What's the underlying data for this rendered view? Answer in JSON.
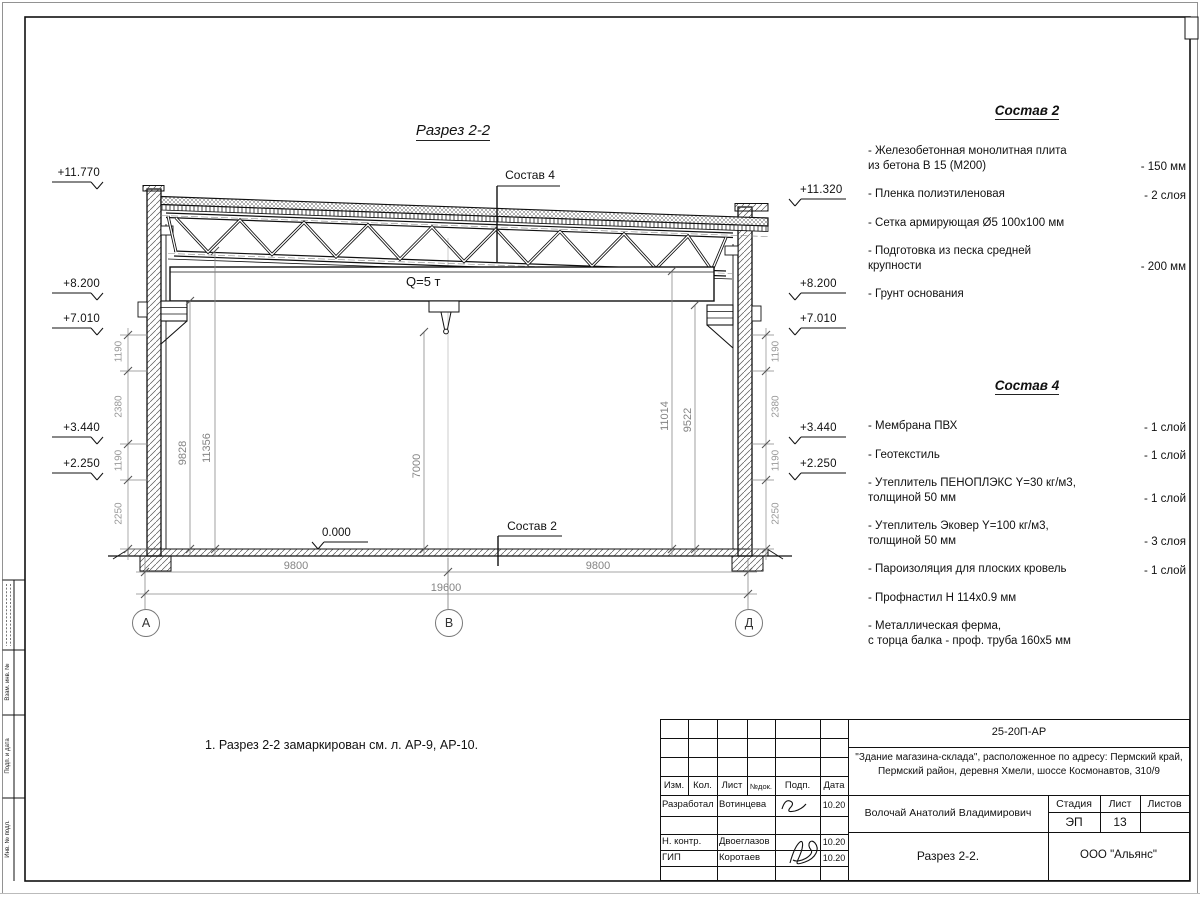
{
  "title": "Разрез 2-2",
  "note": "1. Разрез 2-2 замаркирован см. л. АР-9, АР-10.",
  "drawing": {
    "q_label": "Q=5 т",
    "zero_mark": "0.000",
    "sostav2_ref": "Состав 2",
    "sostav4_ref": "Состав 4",
    "elevations_left": [
      "+11.770",
      "+8.200",
      "+7.010",
      "+3.440",
      "+2.250"
    ],
    "elevations_right": [
      "+11.320",
      "+8.200",
      "+7.010",
      "+3.440",
      "+2.250"
    ],
    "inner_dims": [
      "9828",
      "11356",
      "7000",
      "11014",
      "9522"
    ],
    "chain": [
      "1190",
      "2380",
      "1190",
      "2250"
    ],
    "bottom_dims": [
      "9800",
      "9800",
      "19600"
    ],
    "axes": [
      "А",
      "В",
      "Д"
    ]
  },
  "compositions": [
    {
      "heading": "Состав 2",
      "items": [
        {
          "text": "- Железобетонная  монолитная плита\nиз бетона В 15 (М200)",
          "value": "- 150 мм"
        },
        {
          "text": "- Пленка полиэтиленовая",
          "value": "- 2 слоя"
        },
        {
          "text": "- Сетка армирующая Ø5 100х100 мм",
          "value": ""
        },
        {
          "text": "- Подготовка из песка средней\nкрупности",
          "value": "- 200 мм"
        },
        {
          "text": "- Грунт основания",
          "value": ""
        }
      ]
    },
    {
      "heading": "Состав 4",
      "items": [
        {
          "text": "- Мембрана ПВХ",
          "value": "- 1 слой"
        },
        {
          "text": "- Геотекстиль",
          "value": "- 1 слой"
        },
        {
          "text": "- Утеплитель ПЕНОПЛЭКС Y=30 кг/м3,\nтолщиной 50 мм",
          "value": "- 1 слой"
        },
        {
          "text": "- Утеплитель Эковер Y=100 кг/м3,\nтолщиной 50 мм",
          "value": "- 3 слоя"
        },
        {
          "text": "- Пароизоляция для плоских кровель",
          "value": "- 1 слой"
        },
        {
          "text": "- Профнастил Н 114х0.9 мм",
          "value": ""
        },
        {
          "text": "- Металлическая ферма,\nс торца балка - проф. труба 160х5 мм",
          "value": ""
        }
      ]
    }
  ],
  "titleblock": {
    "doc_number": "25-20П-АР",
    "project_line1": "\"Здание магазина-склада\", расположенное по адресу: Пермский край,",
    "project_line2": "Пермский район, деревня Хмели, шоссе Космонавтов, 310/9",
    "header": {
      "izm": "Изм.",
      "kol": "Кол.",
      "list": "Лист",
      "ndok": "№док.",
      "podp": "Подп.",
      "data": "Дата"
    },
    "rows": [
      {
        "role": "Разработал",
        "name": "Вотинцева",
        "date": "10.20"
      },
      {
        "role": "Н. контр.",
        "name": "Двоеглазов",
        "date": "10.20"
      },
      {
        "role": "ГИП",
        "name": "Коротаев",
        "date": "10.20"
      }
    ],
    "client": "Волочай Анатолий Владимирович",
    "sheet_title": "Разрез 2-2.",
    "stage_label": "Стадия",
    "sheet_label": "Лист",
    "sheets_label": "Листов",
    "stage": "ЭП",
    "sheet_number": "13",
    "sheets_total": "",
    "company": "ООО \"Альянс\""
  },
  "side_stamp": {
    "labels": [
      "Взам. инв. №",
      "Подп. и дата",
      "Инв. № подл."
    ]
  }
}
